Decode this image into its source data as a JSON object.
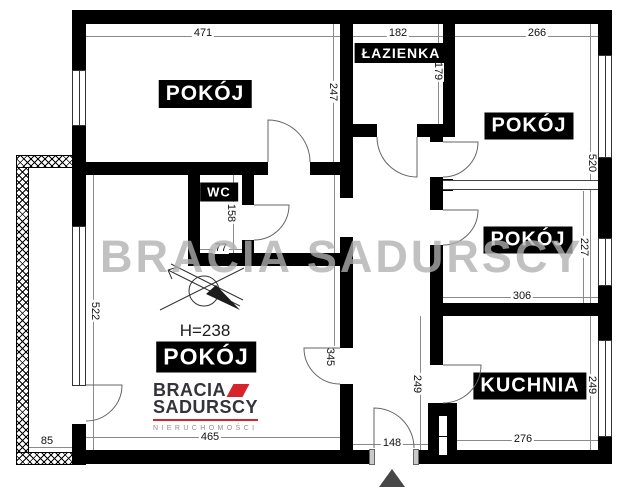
{
  "plan": {
    "watermark": "BRACIA SADURSCY",
    "height_note": "H=238",
    "rooms": [
      {
        "id": "room-top-left",
        "label": "POKÓJ"
      },
      {
        "id": "bathroom",
        "label": "ŁAZIENKA"
      },
      {
        "id": "room-top-right",
        "label": "POKÓJ"
      },
      {
        "id": "room-mid-right",
        "label": "POKÓJ"
      },
      {
        "id": "wc",
        "label": "WC"
      },
      {
        "id": "room-bottom-left",
        "label": "POKÓJ"
      },
      {
        "id": "kitchen",
        "label": "KUCHNIA"
      }
    ],
    "dimensions": {
      "top_left_width": "471",
      "bathroom_width": "182",
      "top_right_width": "266",
      "top_left_height": "247",
      "bathroom_height": "179",
      "right_column_height": "520",
      "mid_right_height": "227",
      "mid_right_width": "306",
      "wc_height": "158",
      "wc_width": "77",
      "bottom_left_height": "522",
      "door_offset": "345",
      "hall_height": "249",
      "kitchen_height": "249",
      "kitchen_width": "276",
      "entrance_width": "148",
      "bottom_left_width": "465",
      "balcony_width": "85"
    },
    "logo": {
      "line1": "BRACIA",
      "line2": "SADURSCY",
      "line3": "NIERUCHOMOŚCI"
    },
    "colors": {
      "wall": "#000000",
      "accent_red": "#d8232a",
      "watermark_gray": "#afafaf"
    }
  }
}
